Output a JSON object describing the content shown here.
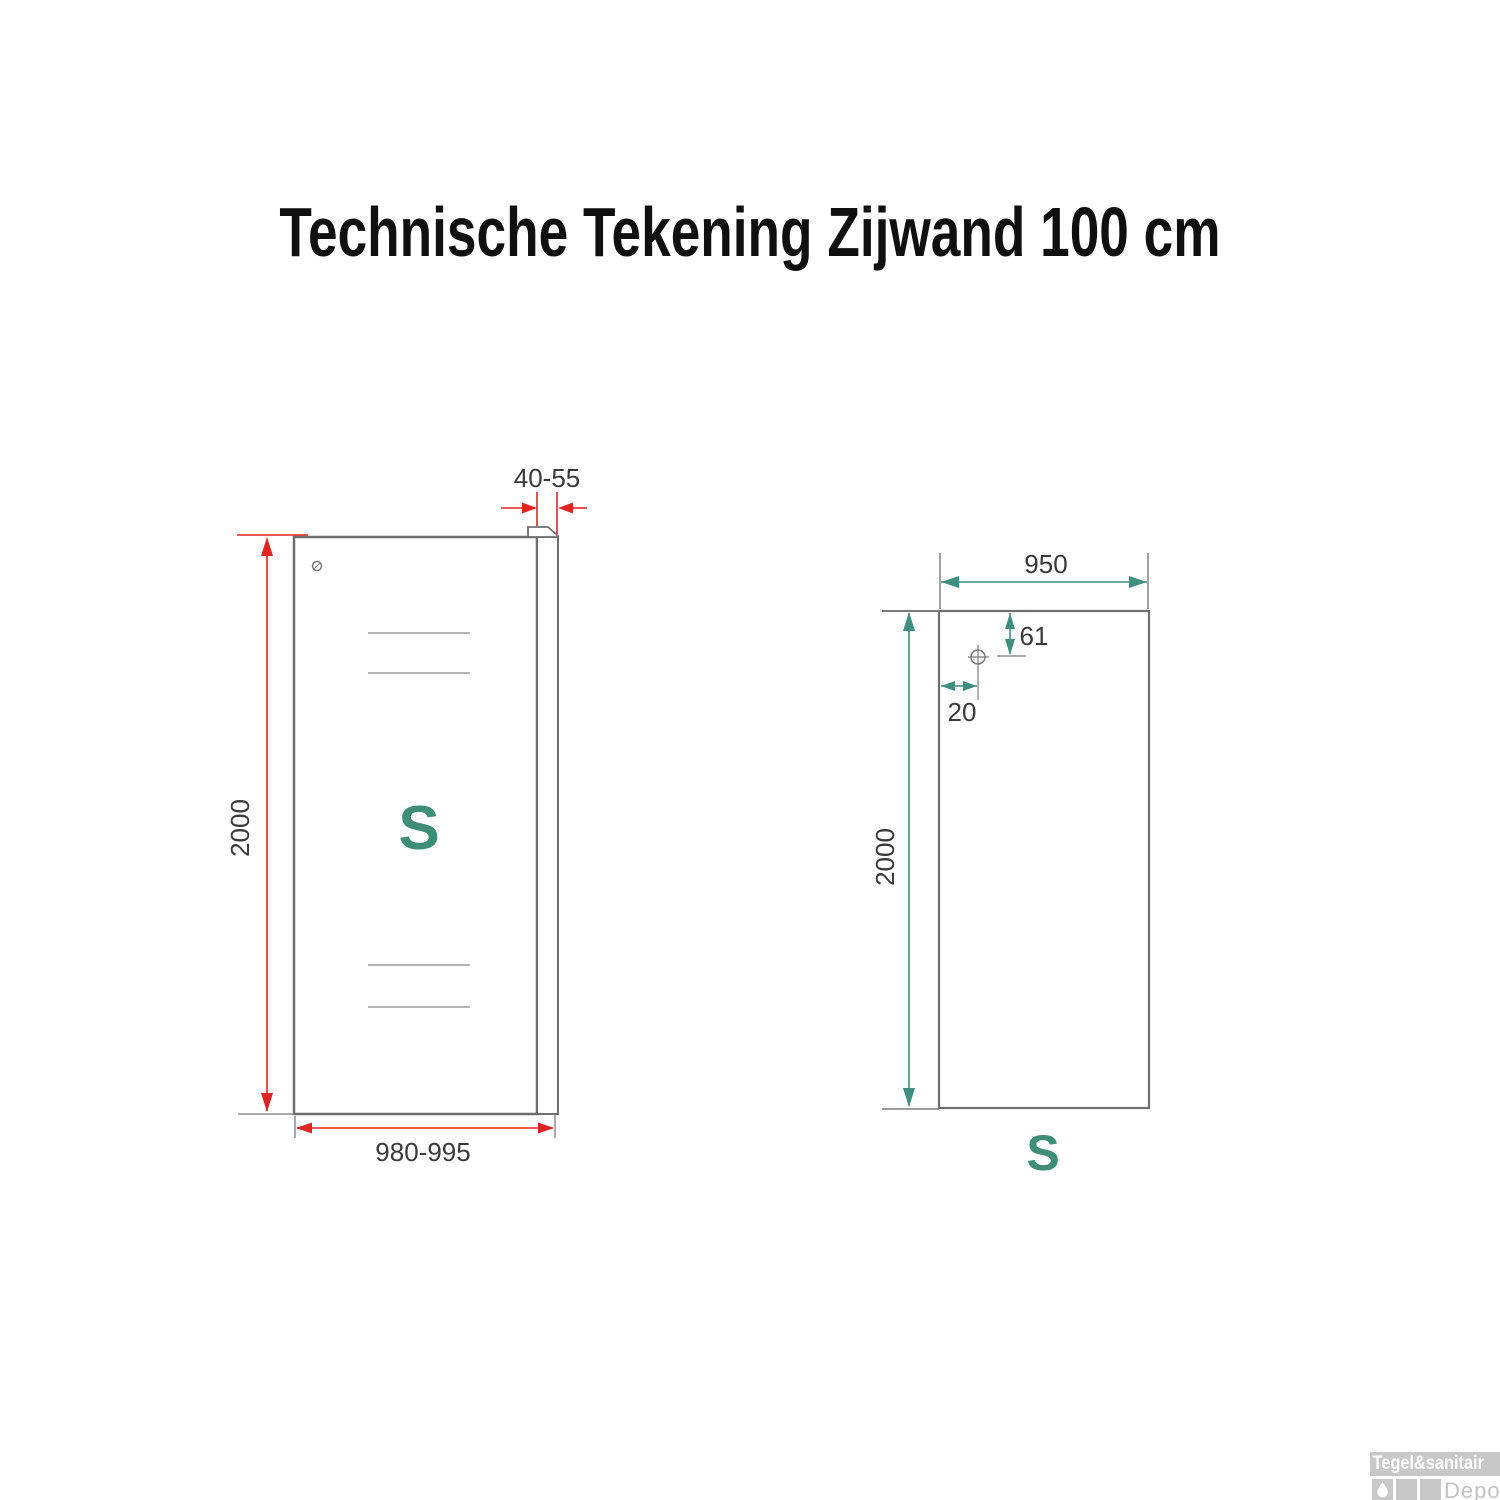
{
  "title": "Technische Tekening Zijwand 100 cm",
  "colors": {
    "dimension_red": "#e02424",
    "dimension_teal": "#3f8e80",
    "marking_teal": "#3e8d76",
    "outline_gray": "#6e6e6e",
    "ext_gray": "#7a7a7a",
    "etch_gray": "#9a9a9a",
    "label_dark": "#3a3a3a",
    "logo_gray": "#c8c8c8",
    "logo_text_white": "#ffffff",
    "depot_gray": "#c3c3c3"
  },
  "front_view": {
    "height_label": "2000",
    "width_label": "980-995",
    "profile_width_label": "40-55",
    "glass_marking": "S"
  },
  "glass_view": {
    "width_label": "950",
    "height_label": "2000",
    "hole_top_offset_label": "61",
    "hole_side_offset_label": "20",
    "glass_marking": "S"
  },
  "logo": {
    "brand": "Tegel&sanitair",
    "sub": "Depot"
  }
}
